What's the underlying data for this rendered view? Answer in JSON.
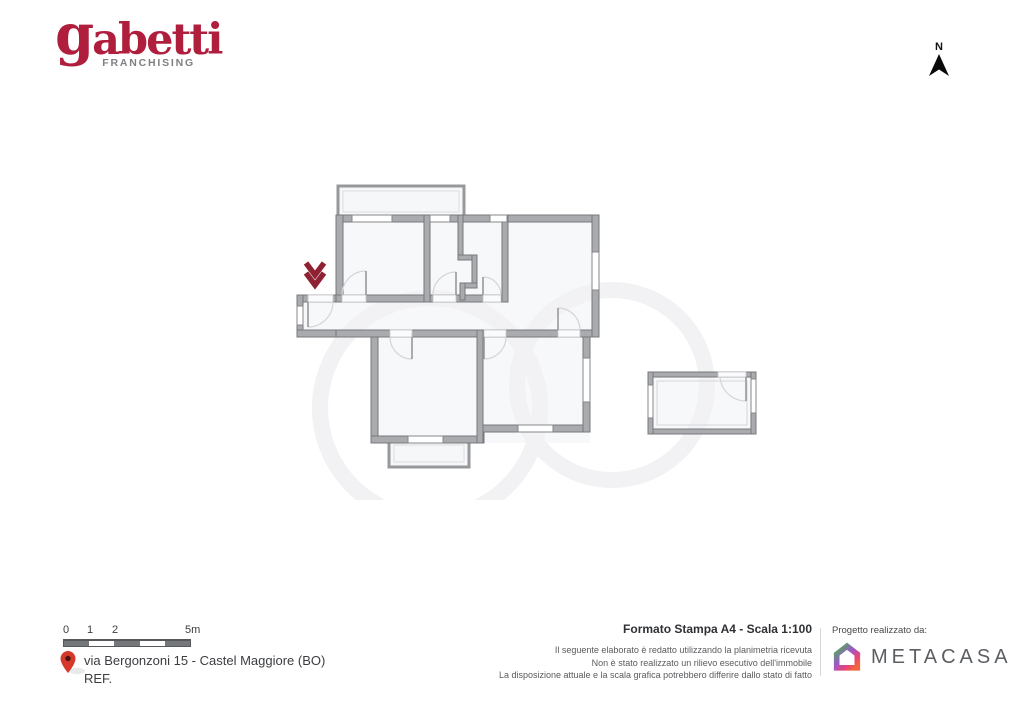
{
  "header": {
    "brand": {
      "wordmark": "gabetti",
      "tagline": "FRANCHISING"
    },
    "compass": {
      "label": "N"
    }
  },
  "floor_plan": {
    "kind": "apartment floor plan with detached annex room",
    "entrance_marker": "double-chevron-down"
  },
  "footer": {
    "scale_bar": {
      "labels": [
        "0",
        "1",
        "2",
        "5m"
      ]
    },
    "address": {
      "line1": "via Bergonzoni 15 - Castel Maggiore (BO)",
      "line2": "REF."
    },
    "print": {
      "title": "Formato Stampa A4 - Scala 1:100",
      "disclaimer": [
        "Il seguente elaborato è redatto utilizzando la planimetria ricevuta",
        "Non è stato realizzato un rilievo esecutivo dell'immobile",
        "La disposizione attuale e la scala grafica potrebbero differire dallo stato di fatto"
      ]
    },
    "credits": {
      "label": "Progetto realizzato da:",
      "brand": "METACASA"
    }
  },
  "colors": {
    "gabetti_red": "#b01e3d",
    "franchising_gray": "#7e8083",
    "entrance_marker_red": "#8e2233",
    "pin_red": "#d6392c",
    "wall_gray": "#a9abae",
    "room_fill": "#f7f8f9",
    "metacasa_text_gray": "#5b5e62",
    "metacasa_gradient": [
      "#45b549",
      "#9b59c8",
      "#e8417e",
      "#f0663c"
    ]
  }
}
